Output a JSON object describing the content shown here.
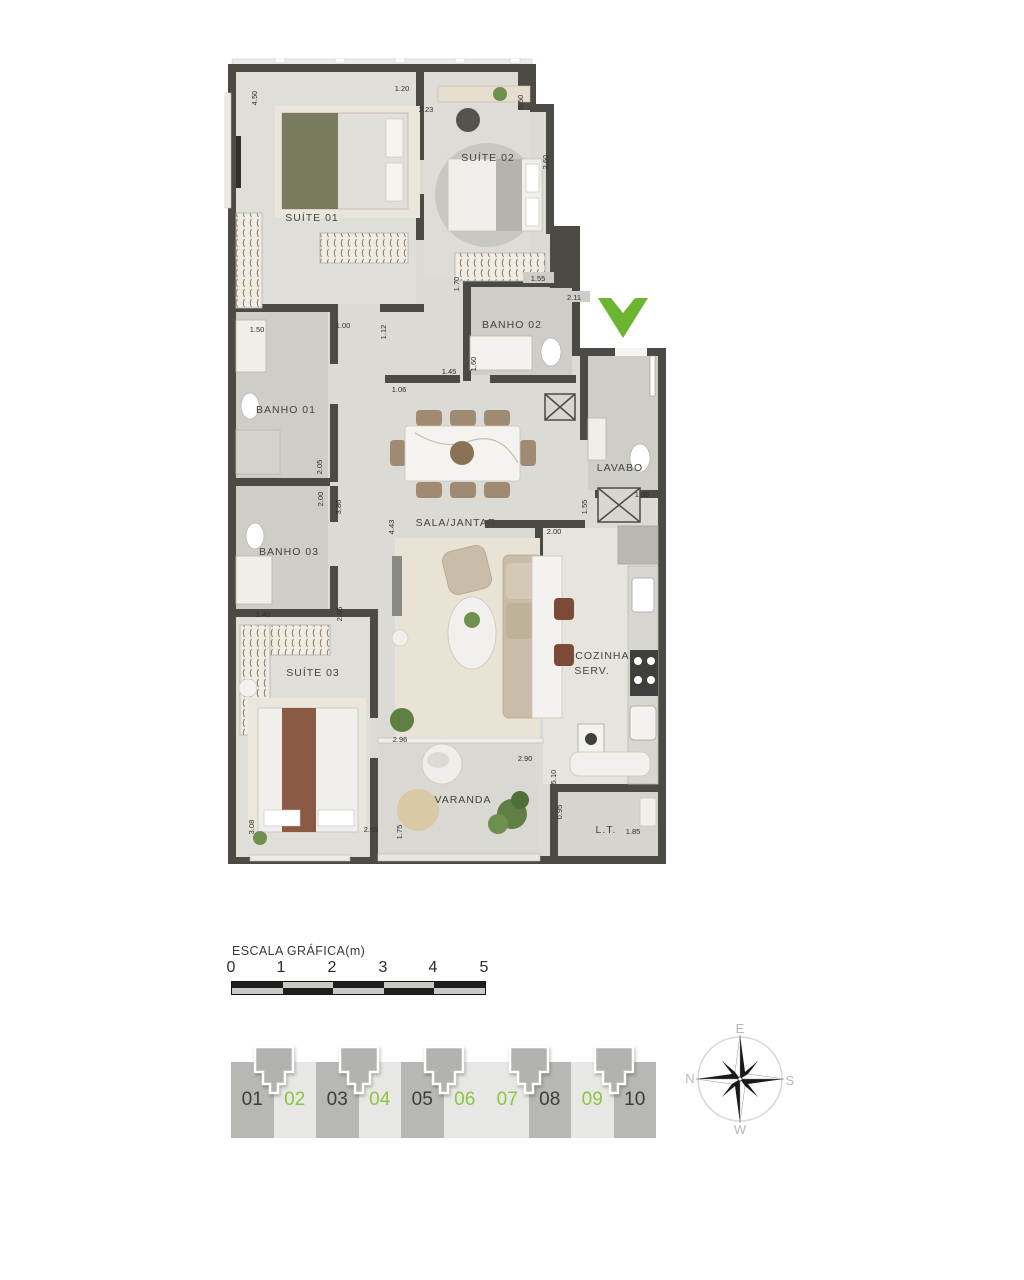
{
  "plan": {
    "rooms": [
      {
        "id": "suite-01",
        "label": "SUÍTE 01"
      },
      {
        "id": "suite-02",
        "label": "SUÍTE 02"
      },
      {
        "id": "banho-02",
        "label": "BANHO 02"
      },
      {
        "id": "banho-01",
        "label": "BANHO 01"
      },
      {
        "id": "banho-03",
        "label": "BANHO 03"
      },
      {
        "id": "sala-jantar",
        "label": "SALA/JANTAR"
      },
      {
        "id": "lavabo",
        "label": "LAVABO"
      },
      {
        "id": "cozinha-line1",
        "label": "COZINHA /"
      },
      {
        "id": "cozinha-line2",
        "label": "SERV."
      },
      {
        "id": "suite-03",
        "label": "SUÍTE 03"
      },
      {
        "id": "varanda",
        "label": "VARANDA"
      },
      {
        "id": "lt",
        "label": "L.T."
      }
    ],
    "dimensions": [
      {
        "value": "4.50"
      },
      {
        "value": "1.20"
      },
      {
        "value": "2.23"
      },
      {
        "value": "0.50"
      },
      {
        "value": "2.60"
      },
      {
        "value": "1.70"
      },
      {
        "value": "1.55"
      },
      {
        "value": "2.11"
      },
      {
        "value": "1.60"
      },
      {
        "value": "1.45"
      },
      {
        "value": "1.06"
      },
      {
        "value": "1.50"
      },
      {
        "value": "1.00"
      },
      {
        "value": "1.12"
      },
      {
        "value": "2.05"
      },
      {
        "value": "2.00"
      },
      {
        "value": "3.86"
      },
      {
        "value": "4.43"
      },
      {
        "value": "1.55"
      },
      {
        "value": "1.35"
      },
      {
        "value": "2.00"
      },
      {
        "value": "1.40"
      },
      {
        "value": "2.05"
      },
      {
        "value": "2.96"
      },
      {
        "value": "2.90"
      },
      {
        "value": "5.10"
      },
      {
        "value": "0.95"
      },
      {
        "value": "3.08"
      },
      {
        "value": "2.65"
      },
      {
        "value": "1.75"
      },
      {
        "value": "1.85"
      }
    ],
    "orientation_marker": "green-check"
  },
  "scale": {
    "title": "ESCALA GRÁFICA(m)",
    "ticks": [
      "0",
      "1",
      "2",
      "3",
      "4",
      "5"
    ]
  },
  "units": {
    "items": [
      {
        "label": "01",
        "highlighted": false
      },
      {
        "label": "02",
        "highlighted": true
      },
      {
        "label": "03",
        "highlighted": false
      },
      {
        "label": "04",
        "highlighted": true
      },
      {
        "label": "05",
        "highlighted": false
      },
      {
        "label": "06",
        "highlighted": true
      },
      {
        "label": "07",
        "highlighted": true
      },
      {
        "label": "08",
        "highlighted": false
      },
      {
        "label": "09",
        "highlighted": true
      },
      {
        "label": "10",
        "highlighted": false
      }
    ]
  },
  "compass": {
    "top": "E",
    "left": "N",
    "right": "S",
    "bottom": "W"
  },
  "colors": {
    "wall": "#4b4a45",
    "floor": "#dcdad4",
    "accent_green": "#6cb52e",
    "unit_cell_dark": "#b7b7b4",
    "unit_cell_light": "#e7e7e5",
    "unit_text_green": "#8cc63f",
    "unit_text_dark": "#3c3c3c"
  }
}
